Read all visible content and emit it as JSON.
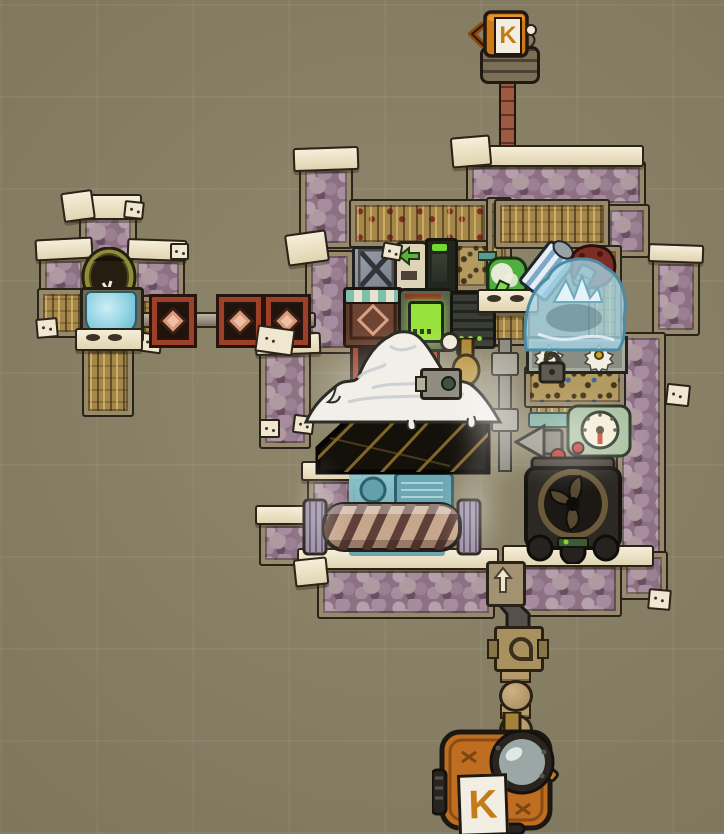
{
  "meta": {
    "scene": "colony-sim base screenshot",
    "canvas": {
      "width": 724,
      "height": 834
    }
  },
  "labels": {
    "top_vent_logo": "K",
    "bottom_pump_logo": "K"
  },
  "palette": {
    "background": "#8a8164",
    "insulated_tile": "#8d7183",
    "insulated_blob": "#b5a0ab",
    "tile_cap_cream": "#f2e9d0",
    "tan_tile": "#a5874a",
    "black_tile": "#14100a",
    "gold_streak": "#96762f",
    "rail_red": "#9c4029",
    "water_blue": "#8fd2e2",
    "pool_teal": "#7fb9c6",
    "goo_white": "#f1efe8",
    "ice_blue": "#a8d8e8",
    "pump_orange": "#c9781c",
    "brass": "#ab8733",
    "screen_green": "#8fe03a",
    "needle_red": "#c03a20"
  },
  "entities": {
    "top-gas-vent": {
      "kind": "mug-shaped vent pump on riser pipe",
      "logo": "K"
    },
    "dome-machine": {
      "kind": "round-front machine in washroom module"
    },
    "water-basin": {
      "kind": "blue water basin"
    },
    "conveyor-rail": {
      "kind": "red rail boxes linked by gray rail",
      "box_count": 4
    },
    "storage-bin": {
      "kind": "metal storage bin with X brace"
    },
    "conveyor-loader": {
      "kind": "cream loader with green left arrow"
    },
    "smart-battery": {
      "kind": "dark battery with green charge bar"
    },
    "ration-box": {
      "kind": "teal-awning ration box with diamond motif"
    },
    "green-screen-machine": {
      "kind": "machine with bright green display"
    },
    "ribbed-cooler": {
      "kind": "dark ribbed machine with green LEDs"
    },
    "brass-pipe": {
      "kind": "brass pipe with bulb joint"
    },
    "sensor-camera": {
      "kind": "small sensor with lens on goo pile"
    },
    "goo-pile": {
      "kind": "white molten pile with drips"
    },
    "black-gold-tiles": {
      "kind": "black tiles with gold veining"
    },
    "water-pool": {
      "kind": "teal pool with submerged pump and reservoir"
    },
    "sieve-drum": {
      "kind": "large spiral drum machine"
    },
    "oxygen-diffuser": {
      "kind": "green flask machine on bracket"
    },
    "gas-canister": {
      "kind": "tilted striped canister"
    },
    "maroon-pump": {
      "kind": "dark red pump blob with ribbed snout"
    },
    "ice-mound": {
      "kind": "translucent ice mound with crystals over vent"
    },
    "mechanized-airlock": {
      "kind": "horizontal gear door with padlock"
    },
    "sensor-gauge": {
      "kind": "dial gauge with red needle and button"
    },
    "horn-valve": {
      "kind": "horn-shaped valve with red knob"
    },
    "fan-gas-pump": {
      "kind": "dark gas pump with three-blade fan"
    },
    "shutoff-valve": {
      "kind": "lever valve box on down pipe"
    },
    "bottom-liquid-pump": {
      "kind": "orange pump with glass dome",
      "logo": "K"
    }
  }
}
